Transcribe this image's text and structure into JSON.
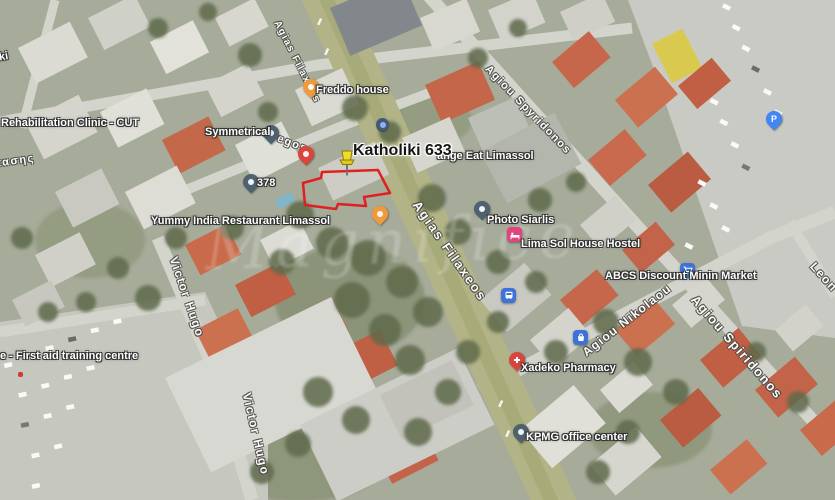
{
  "map": {
    "watermark": "Magnifice",
    "highlight": {
      "label": "Katholiki 633"
    },
    "pois": {
      "rehab_clinic": "Rehabilitation Clinic - CUT",
      "frag_top_left": "iki",
      "frag_greek": "τασης",
      "symmetrical": "Symmetrical",
      "n378": "378",
      "freddo": "Freddo house",
      "orange_eat": "ange Eat Limassol",
      "photo_siarlis": "Photo Siarlis",
      "lima_sol": "Lima Sol House Hostel",
      "abcs": "ABCS Discount Minin Market",
      "yummy": "Yummy India Restaurant Limassol",
      "xadeko": "Xadeko Pharmacy",
      "kpmg": "KPMG office center",
      "first_aid": "e - First aid training centre"
    },
    "streets": {
      "agias_filaxeos_top": "Agias Filaxeos",
      "agias_filaxeos_mid": "Agias Filaxeos",
      "agiou_spyridonos_top": "Agiou Spyridonos",
      "agiou_spiridonos_bottom": "Agiou Spiridonos",
      "agiou_nikolaou": "Agiou Nikolaou",
      "victor_hugo_upper": "Victor Hugo",
      "victor_hugo_lower": "Victor Hugo",
      "gregos": "Gregos",
      "leon_fragment": "Leon"
    },
    "markers": {
      "parking_letter": "P"
    },
    "colors": {
      "poi_blue": "#4285F4",
      "poi_amber": "#F09A3E",
      "poi_slate": "#4E616F",
      "poi_red": "#D9453C",
      "poi_pink": "#E0457B",
      "highlight_pushpin": "#F2DA2C",
      "parcel_outline": "#E02020"
    }
  }
}
